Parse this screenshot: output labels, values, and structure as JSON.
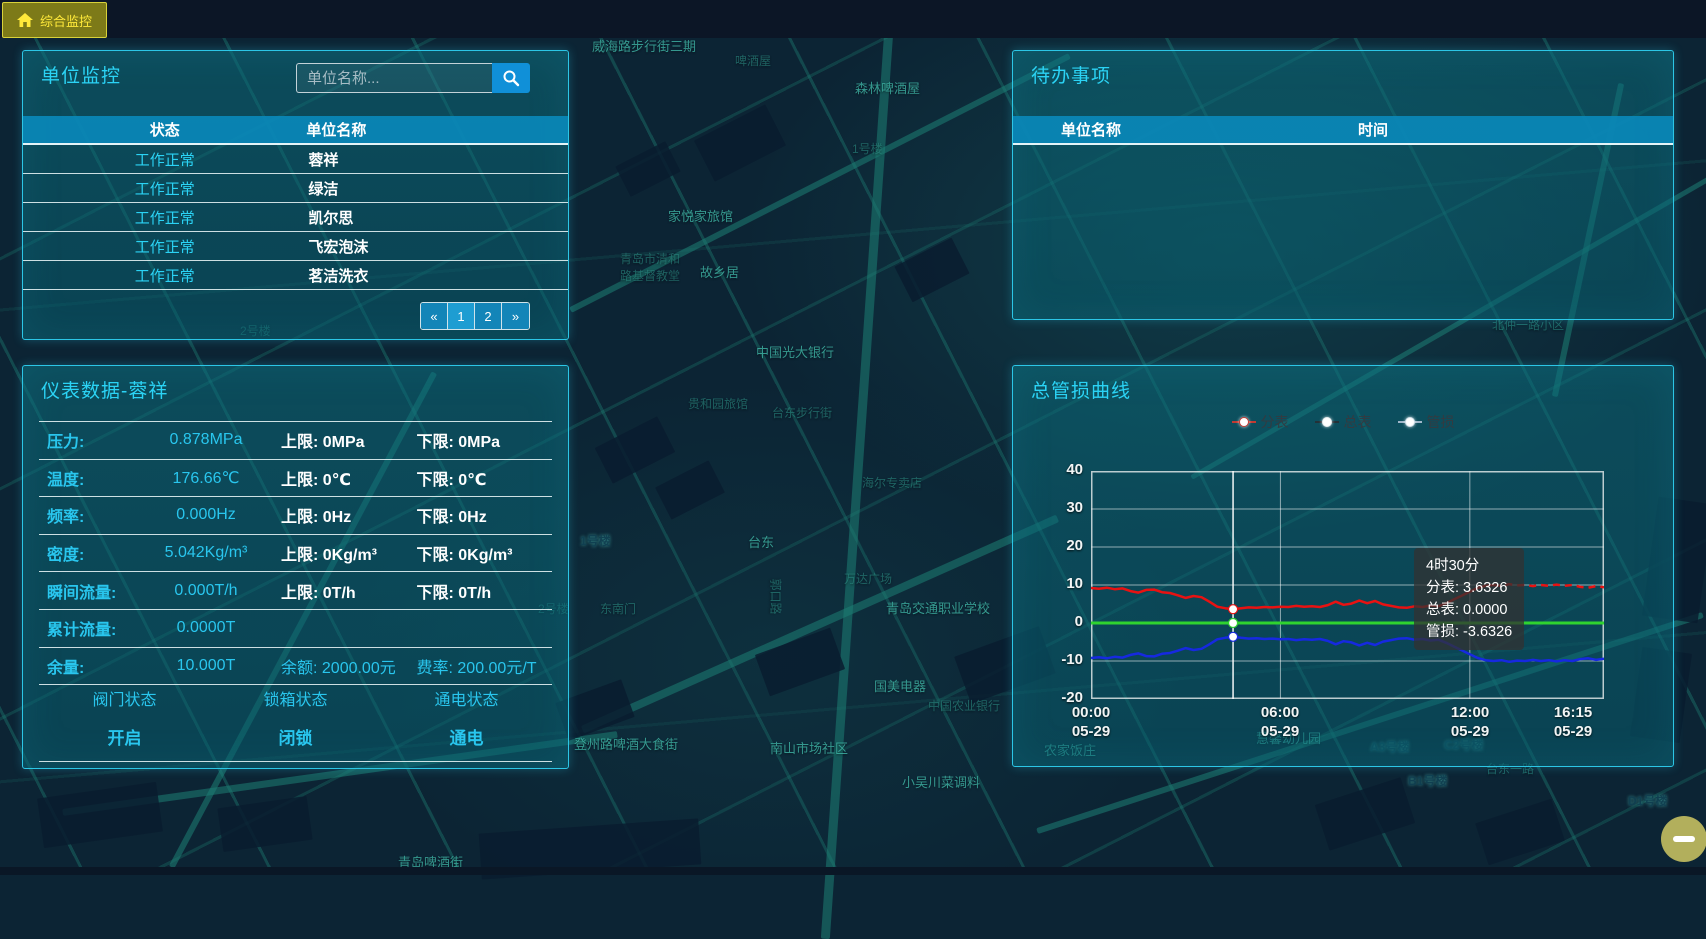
{
  "colors": {
    "accent_cyan": "#29c6ee",
    "panel_border": "#2cc6e6",
    "table_header_bg": "#0a88b8",
    "button_blue": "#1090d8",
    "tab_yellow": "#ffe93a",
    "tab_bg": "#7d7a18",
    "series_red": "#e81212",
    "series_green": "#2fd32f",
    "series_blue": "#1629e0"
  },
  "topbar": {
    "tab_label": "综合监控"
  },
  "unit_monitor_panel": {
    "title": "单位监控",
    "search_placeholder": "单位名称...",
    "table": {
      "columns": [
        "状态",
        "单位名称"
      ],
      "rows": [
        {
          "status": "工作正常",
          "name": "蓉祥"
        },
        {
          "status": "工作正常",
          "name": "绿洁"
        },
        {
          "status": "工作正常",
          "name": "凯尔思"
        },
        {
          "status": "工作正常",
          "name": "飞宏泡沫"
        },
        {
          "status": "工作正常",
          "name": "茗洁洗衣"
        }
      ]
    },
    "pagination": [
      "«",
      "1",
      "2",
      "»"
    ]
  },
  "todo_panel": {
    "title": "待办事项",
    "columns": [
      "单位名称",
      "时间"
    ],
    "rows": []
  },
  "meter_panel": {
    "title": "仪表数据-蓉祥",
    "rows": [
      {
        "label": "压力:",
        "value": "0.878MPa",
        "upper": "上限: 0MPa",
        "lower": "下限: 0MPa"
      },
      {
        "label": "温度:",
        "value": "176.66℃",
        "upper": "上限: 0℃",
        "lower": "下限: 0℃"
      },
      {
        "label": "频率:",
        "value": "0.000Hz",
        "upper": "上限: 0Hz",
        "lower": "下限: 0Hz"
      },
      {
        "label": "密度:",
        "value": "5.042Kg/m³",
        "upper": "上限: 0Kg/m³",
        "lower": "下限: 0Kg/m³"
      },
      {
        "label": "瞬间流量:",
        "value": "0.000T/h",
        "upper": "上限: 0T/h",
        "lower": "下限: 0T/h"
      },
      {
        "label": "累计流量:",
        "value": "0.0000T",
        "upper": "",
        "lower": ""
      },
      {
        "label": "余量:",
        "value": "10.000T",
        "upper": "余额: 2000.00元",
        "lower": "费率: 200.00元/T"
      }
    ],
    "statuses": [
      {
        "label": "阀门状态",
        "value": "开启"
      },
      {
        "label": "锁箱状态",
        "value": "闭锁"
      },
      {
        "label": "通电状态",
        "value": "通电"
      }
    ]
  },
  "chart_panel": {
    "title": "总管损曲线",
    "legend": [
      "分表",
      "总表",
      "管损"
    ]
  },
  "chart_data": {
    "type": "line",
    "title": "总管损曲线",
    "x_unit": "hours_of_day_05-29",
    "x": [
      0,
      0.25,
      0.5,
      0.75,
      1,
      1.25,
      1.5,
      1.75,
      2,
      2.25,
      2.5,
      2.75,
      3,
      3.25,
      3.5,
      3.75,
      4,
      4.25,
      4.5,
      4.75,
      5,
      5.25,
      5.5,
      5.75,
      6,
      6.25,
      6.5,
      6.75,
      7,
      7.25,
      7.5,
      7.75,
      8,
      8.25,
      8.5,
      8.75,
      9,
      9.25,
      9.5,
      9.75,
      10,
      10.25,
      10.5,
      10.75,
      11,
      11.25,
      11.5,
      11.75,
      12,
      12.25,
      12.5,
      12.75,
      13,
      13.25,
      13.5,
      13.75,
      14,
      14.25,
      14.5,
      14.75,
      15,
      15.25,
      15.5,
      15.75,
      16,
      16.25
    ],
    "series": [
      {
        "name": "分表",
        "color": "#e81212",
        "values": [
          9.2,
          9.0,
          9.3,
          8.9,
          9.1,
          8.4,
          8.0,
          8.7,
          8.8,
          8.1,
          7.9,
          7.3,
          6.6,
          7.1,
          6.8,
          5.6,
          4.3,
          3.9,
          3.6326,
          3.9,
          4.1,
          4.0,
          4.2,
          4.1,
          4.3,
          4.2,
          4.5,
          4.3,
          4.4,
          4.2,
          4.7,
          5.6,
          4.8,
          5.1,
          5.9,
          5.2,
          5.8,
          4.9,
          4.5,
          4.1,
          4.0,
          4.4,
          4.2,
          4.6,
          4.4,
          5.2,
          6.2,
          7.2,
          8.2,
          9.2,
          9.8,
          10.0,
          9.8,
          10.2,
          9.9,
          10.0,
          9.7,
          10.0,
          9.8,
          10.1,
          9.8,
          10.0,
          9.5,
          9.3,
          9.7,
          9.4
        ]
      },
      {
        "name": "总表",
        "color": "#2fd32f",
        "values": [
          0,
          0,
          0,
          0,
          0,
          0,
          0,
          0,
          0,
          0,
          0,
          0,
          0,
          0,
          0,
          0,
          0,
          0,
          0,
          0,
          0,
          0,
          0,
          0,
          0,
          0,
          0,
          0,
          0,
          0,
          0,
          0,
          0,
          0,
          0,
          0,
          0,
          0,
          0,
          0,
          0,
          0,
          0,
          0,
          0,
          0,
          0,
          0,
          0,
          0,
          0,
          0,
          0,
          0,
          0,
          0,
          0,
          0,
          0,
          0,
          0,
          0,
          0,
          0,
          0,
          0
        ]
      },
      {
        "name": "管损",
        "color": "#1629e0",
        "values": [
          -9.2,
          -9.0,
          -9.3,
          -8.9,
          -9.1,
          -8.4,
          -8.0,
          -8.7,
          -8.8,
          -8.1,
          -7.9,
          -7.3,
          -6.6,
          -7.1,
          -6.8,
          -5.6,
          -4.3,
          -3.9,
          -3.6326,
          -3.9,
          -4.1,
          -4.0,
          -4.2,
          -4.1,
          -4.3,
          -4.2,
          -4.5,
          -4.3,
          -4.4,
          -4.2,
          -4.7,
          -5.6,
          -4.8,
          -5.1,
          -5.9,
          -5.2,
          -5.8,
          -4.9,
          -4.5,
          -4.1,
          -4.0,
          -4.4,
          -4.2,
          -4.6,
          -4.4,
          -5.2,
          -6.2,
          -7.2,
          -8.2,
          -9.2,
          -9.8,
          -10.0,
          -9.8,
          -10.2,
          -9.9,
          -10.0,
          -9.7,
          -10.0,
          -9.8,
          -10.1,
          -9.8,
          -10.0,
          -9.5,
          -9.3,
          -9.7,
          -9.4
        ]
      }
    ],
    "ylim": [
      -20,
      40
    ],
    "yticks": [
      "40",
      "30",
      "20",
      "10",
      "0",
      "-10",
      "-20"
    ],
    "xticks": [
      {
        "time": "00:00",
        "date": "05-29",
        "t": 0
      },
      {
        "time": "06:00",
        "date": "05-29",
        "t": 6
      },
      {
        "time": "12:00",
        "date": "05-29",
        "t": 12
      },
      {
        "time": "16:15",
        "date": "05-29",
        "t": 16.25
      }
    ],
    "grid": true,
    "legend_position": "top",
    "pointer_t": 4.5,
    "dashed_from_t": 12.75,
    "tooltip": {
      "title": "4时30分",
      "lines": [
        "分表: 3.6326",
        "总表: 0.0000",
        "管损: -3.6326"
      ]
    }
  },
  "zoom_control": {
    "icon": "minus-icon"
  },
  "map": {
    "labels": [
      {
        "x": 612,
        "y": 10,
        "text": "贸易有限公司",
        "cls": "dim"
      },
      {
        "x": 592,
        "y": 36,
        "text": "威海路步行街三期"
      },
      {
        "x": 735,
        "y": 52,
        "text": "啤酒屋",
        "cls": "dim"
      },
      {
        "x": 855,
        "y": 78,
        "text": "森林啤酒屋"
      },
      {
        "x": 852,
        "y": 140,
        "text": "1号楼",
        "cls": "dim"
      },
      {
        "x": 668,
        "y": 206,
        "text": "家悦家旅馆"
      },
      {
        "x": 620,
        "y": 250,
        "text": "青岛市清和\n路基督教堂",
        "cls": "dim"
      },
      {
        "x": 700,
        "y": 262,
        "text": "故乡居"
      },
      {
        "x": 240,
        "y": 322,
        "text": "2号楼",
        "cls": "dim"
      },
      {
        "x": 756,
        "y": 342,
        "text": "中国光大银行"
      },
      {
        "x": 688,
        "y": 395,
        "text": "贵和园旅馆",
        "cls": "dim"
      },
      {
        "x": 772,
        "y": 404,
        "text": "台东步行街",
        "cls": "dim"
      },
      {
        "x": 862,
        "y": 474,
        "text": "海尔专卖店",
        "cls": "dim"
      },
      {
        "x": 580,
        "y": 532,
        "text": "1号楼",
        "cls": "bld-l"
      },
      {
        "x": 748,
        "y": 532,
        "text": "台东"
      },
      {
        "x": 844,
        "y": 570,
        "text": "万达广场",
        "cls": "dim"
      },
      {
        "x": 600,
        "y": 600,
        "text": "东南门",
        "cls": "dim"
      },
      {
        "x": 758,
        "y": 588,
        "text": "郭口路",
        "cls": "dim",
        "rot": 90
      },
      {
        "x": 886,
        "y": 598,
        "text": "青岛交通职业学校"
      },
      {
        "x": 538,
        "y": 600,
        "text": "2号楼",
        "cls": "dim"
      },
      {
        "x": 874,
        "y": 676,
        "text": "国美电器"
      },
      {
        "x": 928,
        "y": 697,
        "text": "中国农业银行",
        "cls": "dim"
      },
      {
        "x": 770,
        "y": 738,
        "text": "南山市场社区"
      },
      {
        "x": 902,
        "y": 772,
        "text": "小吴川菜调料"
      },
      {
        "x": 574,
        "y": 734,
        "text": "登州路啤酒大食街"
      },
      {
        "x": 398,
        "y": 852,
        "text": "青岛啤酒街"
      },
      {
        "x": 1044,
        "y": 740,
        "text": "农家饭庄"
      },
      {
        "x": 1256,
        "y": 728,
        "text": "慧馨幼儿园"
      },
      {
        "x": 1370,
        "y": 738,
        "text": "A3号楼",
        "cls": "bld-l"
      },
      {
        "x": 1444,
        "y": 736,
        "text": "C2号楼",
        "cls": "bld-l"
      },
      {
        "x": 1408,
        "y": 772,
        "text": "B1号楼",
        "cls": "bld-l"
      },
      {
        "x": 1486,
        "y": 760,
        "text": "台东一路",
        "cls": "dim"
      },
      {
        "x": 1492,
        "y": 316,
        "text": "北仲一路小区",
        "cls": "dim"
      },
      {
        "x": 1628,
        "y": 792,
        "text": "D1号楼",
        "cls": "bld-l"
      }
    ]
  }
}
